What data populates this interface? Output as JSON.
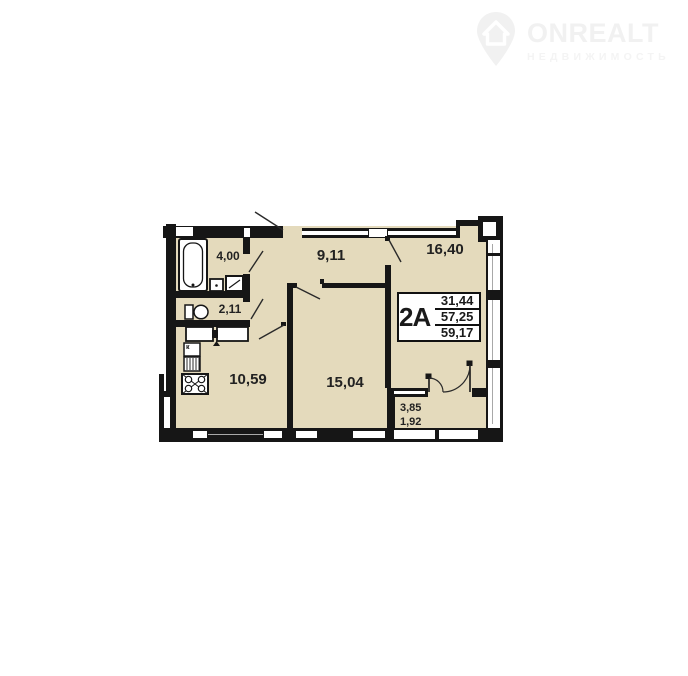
{
  "logo": {
    "brand": "ONREALT",
    "tagline": "НЕДВИЖИМОСТЬ"
  },
  "plan": {
    "unit": "2A",
    "areas": {
      "living": "31,44",
      "usable": "57,25",
      "total": "59,17"
    },
    "rooms": {
      "bathroom": "4,00",
      "wc": "2,11",
      "hallway": "9,11",
      "living_room": "16,40",
      "kitchen": "10,59",
      "bedroom": "15,04",
      "balcony_full": "3,85",
      "balcony_reduced": "1,92"
    },
    "kitchen_marker": "к"
  },
  "colors": {
    "room_fill": "#e4dabc",
    "wall": "#161616",
    "logo_gray": "#f2f2f2"
  }
}
